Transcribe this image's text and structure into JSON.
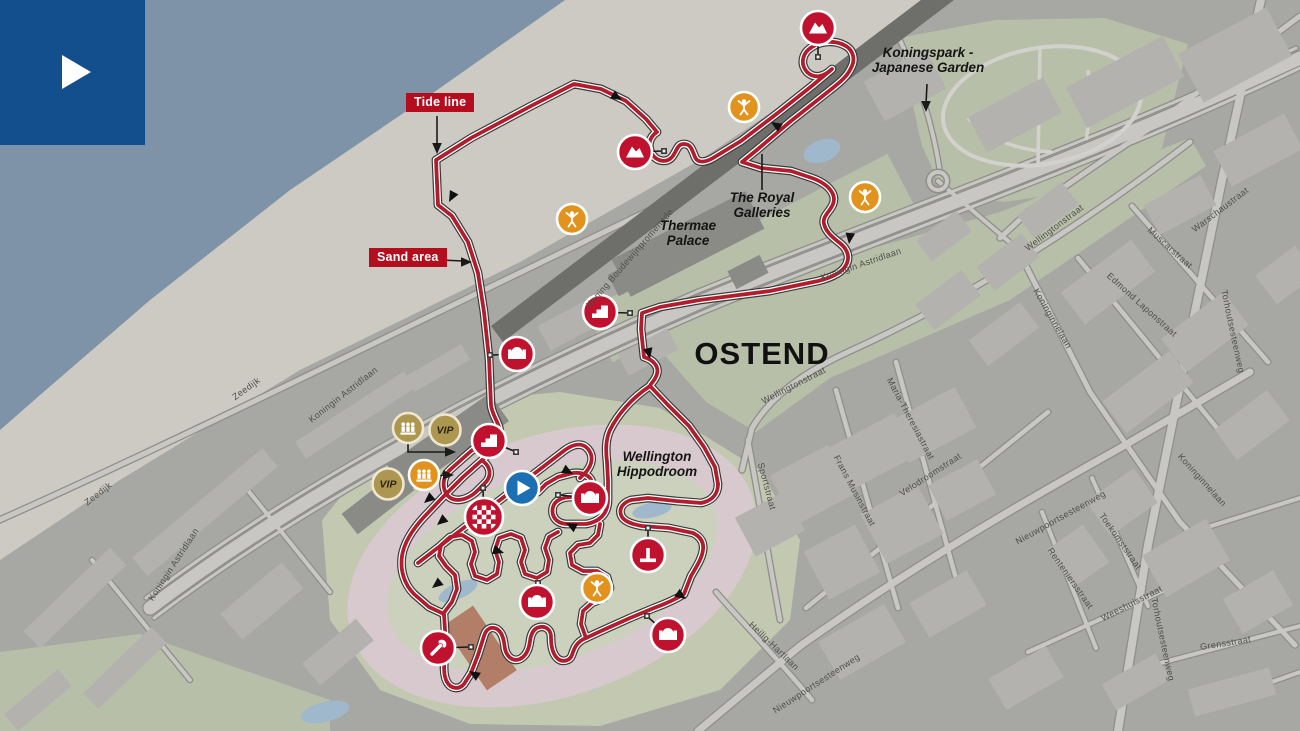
{
  "title": "Ostend cyclocross course map",
  "tags": {
    "tide_line": "Tide line",
    "sand_area": "Sand area"
  },
  "city_label": {
    "text": "OSTEND",
    "x": 762,
    "y": 364,
    "size": 31
  },
  "place_labels": [
    {
      "text": "Thermae\nPalace",
      "x": 688,
      "y": 230
    },
    {
      "text": "The Royal\nGalleries",
      "x": 762,
      "y": 202
    },
    {
      "text": "Koningspark -\nJapanese Garden",
      "x": 928,
      "y": 57
    },
    {
      "text": "Wellington\nHippodroom",
      "x": 657,
      "y": 461
    }
  ],
  "street_labels": [
    {
      "t": "Zeedijk",
      "x": 248,
      "y": 391,
      "r": -36
    },
    {
      "t": "Zeedijk",
      "x": 100,
      "y": 496,
      "r": -38
    },
    {
      "t": "Koningin Astridlaan",
      "x": 345,
      "y": 397,
      "r": -38
    },
    {
      "t": "Koningin Astridlaan",
      "x": 176,
      "y": 566,
      "r": -57
    },
    {
      "t": "Koningin Astridlaan",
      "x": 862,
      "y": 267,
      "r": -19
    },
    {
      "t": "Koning Boudewijnpromenade",
      "x": 632,
      "y": 260,
      "r": -49
    },
    {
      "t": "Warschaustraat",
      "x": 1222,
      "y": 212,
      "r": -37
    },
    {
      "t": "Wellingtonstraat",
      "x": 1056,
      "y": 230,
      "r": -37
    },
    {
      "t": "Wellingtonstraat",
      "x": 795,
      "y": 388,
      "r": -27
    },
    {
      "t": "Muscarstraat",
      "x": 1168,
      "y": 250,
      "r": 42
    },
    {
      "t": "Edmond Laponstraat",
      "x": 1140,
      "y": 307,
      "r": 42
    },
    {
      "t": "Koninginnelaan",
      "x": 1050,
      "y": 320,
      "r": 60
    },
    {
      "t": "Koninginnelaan",
      "x": 1200,
      "y": 482,
      "r": 48
    },
    {
      "t": "Torhoutsesteenweg",
      "x": 1230,
      "y": 332,
      "r": 78
    },
    {
      "t": "Torhoutsesteenweg",
      "x": 1160,
      "y": 640,
      "r": 78
    },
    {
      "t": "Maria-Theresiastraat",
      "x": 908,
      "y": 420,
      "r": 62
    },
    {
      "t": "Frans Musinstraat",
      "x": 852,
      "y": 492,
      "r": 62
    },
    {
      "t": "Velodroomstraat",
      "x": 932,
      "y": 477,
      "r": -33
    },
    {
      "t": "Sportstraat",
      "x": 764,
      "y": 487,
      "r": 75
    },
    {
      "t": "Nieuwpoortsesteenweg",
      "x": 1062,
      "y": 520,
      "r": -29
    },
    {
      "t": "Nieuwpoortsesteenweg",
      "x": 818,
      "y": 686,
      "r": -33
    },
    {
      "t": "Toekomststraat",
      "x": 1118,
      "y": 543,
      "r": 55
    },
    {
      "t": "Renteniersstraat",
      "x": 1068,
      "y": 580,
      "r": 55
    },
    {
      "t": "Weeshuisstraat",
      "x": 1133,
      "y": 606,
      "r": -27
    },
    {
      "t": "Grensstraat",
      "x": 1226,
      "y": 646,
      "r": -9
    },
    {
      "t": "Heilig-Hartlaan",
      "x": 772,
      "y": 648,
      "r": 44
    }
  ],
  "map": {
    "colors": {
      "sea": "#7E93A7",
      "beach": "#CCCAC2",
      "urban": "#A7A7A3",
      "green": "#B8BFA8",
      "hippoGreen": "#C2C9B0",
      "track": "#D8C9CE",
      "infield": "#CCD1BD",
      "building": "#B3B2AE",
      "buildingDark": "#8A8A86",
      "band": "#6E6E6A",
      "roadFill": "#C8C7C3",
      "roadCase": "#8F8F8B",
      "parkPath": "#D2D1CD",
      "pond": "#9FB8CB",
      "pit": "#B27E68",
      "courseRed": "#B01E2E",
      "courseCase": "#FFFFFF",
      "courseEdge": "#3A3A3A",
      "tagRed": "#B30D1E",
      "iconRed": "#C0122F",
      "orange": "#E2931D",
      "gold": "#AD9750",
      "goldRing": "#EFE7CF",
      "blue": "#1B6FB2",
      "logoBlue": "#134F8D",
      "ink": "#141414",
      "streetInk": "#4E4E4A"
    },
    "zones": {
      "sea": "0,0 565,0 430,95 290,190 150,300 40,395 0,430",
      "beach": "565,0 430,95 290,190 150,300 40,395 0,430 0,560 120,480 300,370 520,262 700,160 940,0",
      "greens": [
        "640,314 1000,212 1190,138 1206,166 1010,300 830,378 756,432 706,402 662,352",
        "898,38 995,20 1105,18 1188,44 1162,148 1096,188 1005,202 944,194 922,146",
        "0,652 140,634 330,700 330,731 0,731"
      ],
      "greenRects": [
        [
          750,
          258,
          340,
          58,
          -27.5
        ]
      ]
    },
    "hippodrome": {
      "blob": "322,520 380,448 470,400 560,392 660,408 760,470 800,540 790,620 720,690 600,726 470,724 380,690 330,620",
      "track": [
        552,
        566,
        212,
        130,
        -19.5
      ],
      "infield": [
        552,
        566,
        172,
        94,
        -19.5
      ],
      "parking": [
        543,
        389,
        46,
        13,
        -14
      ]
    },
    "streets": [
      {
        "d": "M150,608 C320,480 520,380 700,302 C900,220 1080,160 1300,58",
        "w": 13
      },
      {
        "d": "M146,598 C316,470 516,370 696,292 C896,210 1076,150 1296,48",
        "w": 3
      },
      {
        "d": "M154,618 C324,490 524,390 704,312 C904,230 1084,170 1300,68",
        "w": 3
      },
      {
        "d": "M-5,522 C180,440 420,320 650,210",
        "w": 5
      },
      {
        "d": "M1300,16 L1150,128 1028,212 1000,238",
        "w": 5
      },
      {
        "d": "M1190,142 C1050,250 940,310 848,352 C800,374 770,398 752,428 L742,470",
        "w": 5
      },
      {
        "d": "M748,440 L780,620",
        "w": 4.5
      },
      {
        "d": "M836,390 L898,608",
        "w": 4.5
      },
      {
        "d": "M896,362 L962,600",
        "w": 4.5
      },
      {
        "d": "M806,608 L1048,412",
        "w": 4.5
      },
      {
        "d": "M1078,258 L1235,450",
        "w": 4.5
      },
      {
        "d": "M1132,206 L1268,362",
        "w": 4.5
      },
      {
        "d": "M1016,246 L1090,392 1180,522 1295,645",
        "w": 5
      },
      {
        "d": "M1262,-5 L1222,180 1185,360 1148,545 1118,731",
        "w": 8
      },
      {
        "d": "M698,731 L800,646 C900,575 1000,515 1120,448 L1250,372",
        "w": 7
      },
      {
        "d": "M1092,478 L1148,606",
        "w": 4
      },
      {
        "d": "M1042,512 L1096,648",
        "w": 4
      },
      {
        "d": "M1028,652 L1178,584",
        "w": 4
      },
      {
        "d": "M1142,668 L1300,626",
        "w": 4
      },
      {
        "d": "M716,592 C740,620 770,650 812,700",
        "w": 4.5
      },
      {
        "d": "M940,172 Q930,105 899,38",
        "w": 4
      },
      {
        "d": "M938,181 L1014,246",
        "w": 4
      },
      {
        "d": "M238,478 L330,592",
        "w": 4
      },
      {
        "d": "M92,560 L190,680",
        "w": 4
      },
      {
        "d": "M1192,532 L1300,498",
        "w": 4
      },
      {
        "d": "M1238,694 L1300,672",
        "w": 4
      }
    ],
    "roundabout": [
      938,
      181,
      9
    ],
    "park_paths": [
      "M968,118 Q1000,150 1052,152",
      "M1088,70 Q1092,110 1086,140",
      "M1040,48 L1038,164"
    ],
    "park_ring": [
      1042,
      106,
      100,
      58,
      -10
    ],
    "band": {
      "d": "M497,334 L948,-8",
      "w": 20
    },
    "buildings": [
      [
        355,
        415,
        130,
        20,
        -33,
        0
      ],
      [
        205,
        512,
        170,
        24,
        -40,
        0
      ],
      [
        75,
        598,
        120,
        24,
        -44,
        0
      ],
      [
        125,
        668,
        95,
        22,
        -44,
        0
      ],
      [
        262,
        601,
        80,
        34,
        -40,
        0
      ],
      [
        338,
        652,
        70,
        28,
        -40,
        0
      ],
      [
        438,
        368,
        64,
        18,
        -30,
        0
      ],
      [
        38,
        700,
        70,
        22,
        -40,
        0
      ],
      [
        575,
        322,
        70,
        28,
        -28,
        0
      ],
      [
        648,
        352,
        56,
        24,
        -28,
        0
      ],
      [
        688,
        244,
        150,
        42,
        -27,
        1
      ],
      [
        640,
        272,
        60,
        24,
        -27,
        1
      ],
      [
        748,
        272,
        36,
        20,
        -27,
        1
      ],
      [
        448,
        443,
        125,
        34,
        -35,
        1
      ],
      [
        378,
        502,
        72,
        26,
        -38,
        1
      ],
      [
        1235,
        55,
        100,
        55,
        -28,
        0
      ],
      [
        1125,
        82,
        110,
        46,
        -28,
        0
      ],
      [
        1015,
        115,
        85,
        40,
        -28,
        0
      ],
      [
        905,
        85,
        70,
        45,
        -28,
        0
      ],
      [
        1258,
        150,
        80,
        40,
        -28,
        0
      ],
      [
        1180,
        205,
        64,
        34,
        -28,
        0
      ],
      [
        1108,
        282,
        88,
        40,
        -37,
        0
      ],
      [
        1205,
        332,
        78,
        42,
        -37,
        0
      ],
      [
        1148,
        392,
        84,
        40,
        -37,
        0
      ],
      [
        1252,
        425,
        66,
        38,
        -37,
        0
      ],
      [
        1286,
        275,
        50,
        36,
        -37,
        0
      ],
      [
        1008,
        262,
        56,
        30,
        -37,
        0
      ],
      [
        948,
        300,
        58,
        32,
        -37,
        0
      ],
      [
        1004,
        334,
        64,
        32,
        -37,
        0
      ],
      [
        812,
        485,
        56,
        66,
        62,
        0
      ],
      [
        872,
        452,
        48,
        76,
        62,
        0
      ],
      [
        932,
        425,
        46,
        76,
        62,
        0
      ],
      [
        902,
        524,
        56,
        64,
        62,
        0
      ],
      [
        842,
        562,
        54,
        58,
        62,
        0
      ],
      [
        962,
        490,
        40,
        56,
        62,
        0
      ],
      [
        770,
        524,
        44,
        56,
        62,
        0
      ],
      [
        1122,
        502,
        42,
        58,
        55,
        0
      ],
      [
        1078,
        556,
        46,
        44,
        55,
        0
      ],
      [
        1186,
        558,
        74,
        48,
        -30,
        0
      ],
      [
        1258,
        602,
        58,
        40,
        -30,
        0
      ],
      [
        1136,
        682,
        62,
        30,
        -30,
        0
      ],
      [
        1232,
        692,
        84,
        28,
        -15,
        0
      ],
      [
        862,
        642,
        76,
        44,
        -30,
        0
      ],
      [
        948,
        604,
        66,
        40,
        -30,
        0
      ],
      [
        1026,
        678,
        66,
        36,
        -30,
        0
      ],
      [
        944,
        236,
        50,
        26,
        -37,
        0
      ],
      [
        1048,
        210,
        56,
        28,
        -37,
        0
      ]
    ],
    "pit": [
      480,
      648,
      36,
      78,
      -34
    ],
    "ponds": [
      [
        652,
        510,
        40,
        15,
        -12
      ],
      [
        458,
        591,
        42,
        16,
        -24
      ],
      [
        325,
        712,
        50,
        20,
        -14
      ],
      [
        822,
        151,
        38,
        22,
        -20
      ]
    ],
    "course": {
      "paths": [
        "M489,358 L484,312 478,273 468,242 452,216 438,205 436,160 471,138 531,106 574,84 601,89 626,101 646,119 657,132 C649,137 647,147 652,154 C657,162 667,163 672,157 C677,151 677,144 684,144 C691,144 692,150 695,157 C698,164 706,162 713,158 L741,141 779,112 813,85 832,69 C824,77 814,79 807,72 C800,64 802,53 812,47 C821,41 834,40 844,45 C853,49 856,59 851,68 C847,77 839,83 829,91 L791,121 758,149 742,162 L761,168 791,171 809,177 C828,183 837,194 833,204 C830,212 822,216 824,224 C826,232 832,237 841,244 C848,250 850,258 846,265 C842,273 830,278 818,281 L770,291 700,300 660,307 642,313 L641,329 644,357 C654,360 659,367 657,374 C655,381 650,384 650,386 L668,405 689,426 704,447 715,467 718,484",
        "M718,484 C718,495 711,501 701,503 L676,501 648,498 631,500 C622,503 619,509 621,515 C623,521 631,524 642,526 L669,528 693,533 C701,537 704,543 703,550 C702,558 697,566 691,576 L684,594 C676,599 665,604 654,608 L630,618 601,631 586,638 C576,642 574,649 572,655 C570,661 562,663 557,658 C552,653 551,645 551,637 C551,630 546,626 540,627 C534,628 531,633 530,641 C529,649 526,656 520,659 C513,662 507,657 505,649 C504,641 503,633 497,629 C491,626 486,629 484,636 L478,655 471,673 464,684 C459,690 451,689 447,682 C443,675 444,664 445,652 L445,630 444,614 L429,607 414,594 C404,584 400,570 402,556 C404,543 412,530 424,517 L443,497 463,477 481,461 495,448 C500,441 501,434 499,427 C497,420 492,414 491,405 L489,358",
        "M418,563 L565,450 C575,443 583,443 588,449 C594,456 592,465 586,472 L580,478",
        "M650,386 C632,398 618,414 610,430 C605,441 606,452 607,462 L608,480 608,500 C608,514 599,522 586,524 L566,524 C555,523 551,515 553,507 C555,500 563,497 572,497 L583,496 C591,495 594,489 592,482 C590,475 582,472 573,473 L558,477 546,484 538,492",
        "M498,430 L470,452 452,468 C441,477 442,489 448,496 C455,503 467,500 476,492 L486,482 C492,475 490,467 484,462",
        "M443,614 L452,602 457,589 455,575 446,566 439,556 441,545 450,537 462,535 472,541 475,552 471,564 475,576 487,580 497,574 499,562 495,550 499,538 511,534 521,538 525,550 521,562 525,574 537,578 547,572 549,560 545,548 549,537 558,532",
        "M586,638 L581,624 583,611 592,603 604,598 610,588 607,577 597,571 583,571 572,565 570,553 578,545 590,543 598,535 600,524"
      ],
      "arrows": [
        [
          622,
          100,
          30
        ],
        [
          449,
          202,
          118
        ],
        [
          771,
          122,
          212
        ],
        [
          849,
          244,
          97
        ],
        [
          650,
          359,
          78
        ],
        [
          573,
          474,
          28
        ],
        [
          686,
          599,
          35
        ],
        [
          424,
          503,
          140
        ],
        [
          437,
          525,
          140
        ],
        [
          504,
          553,
          18
        ],
        [
          432,
          588,
          142
        ],
        [
          469,
          671,
          212
        ],
        [
          566,
          523,
          207
        ]
      ],
      "markers": [
        [
          664,
          151
        ],
        [
          818,
          57
        ],
        [
          630,
          313
        ],
        [
          490,
          355
        ],
        [
          516,
          452
        ],
        [
          483,
          488
        ],
        [
          558,
          495
        ],
        [
          648,
          528
        ],
        [
          538,
          583
        ],
        [
          647,
          616
        ],
        [
          471,
          647
        ]
      ]
    },
    "connectors": [
      {
        "d": "M635,152 L662,151"
      },
      {
        "d": "M818,30 L818,55"
      },
      {
        "d": "M600,312 L628,313"
      },
      {
        "d": "M517,354 L492,355"
      },
      {
        "d": "M489,441 L514,451"
      },
      {
        "d": "M484,515 L483,490"
      },
      {
        "d": "M588,498 L560,495"
      },
      {
        "d": "M648,553 L648,530"
      },
      {
        "d": "M537,600 L538,585"
      },
      {
        "d": "M666,633 L649,618"
      },
      {
        "d": "M440,648 L469,647"
      },
      {
        "d": "M408,430 L408,452 L448,452",
        "head": [
          456,
          452,
          0
        ]
      },
      {
        "d": "M424,477 L446,475",
        "head": [
          454,
          475,
          0
        ]
      },
      {
        "d": "M437,116 L437,146",
        "head": [
          437,
          154,
          90
        ]
      },
      {
        "d": "M440,260 L464,261",
        "head": [
          472,
          262,
          0
        ]
      },
      {
        "d": "M762,190 L762,154"
      },
      {
        "d": "M927,84 L926,104",
        "head": [
          926,
          112,
          90
        ]
      }
    ],
    "icons": [
      {
        "type": "mountain",
        "name": "sand-dune-icon",
        "x": 635,
        "y": 152
      },
      {
        "type": "mountain",
        "name": "sand-dune-icon",
        "x": 818,
        "y": 28
      },
      {
        "type": "fans",
        "name": "fan-zone-icon",
        "x": 572,
        "y": 219
      },
      {
        "type": "fans",
        "name": "fan-zone-icon",
        "x": 744,
        "y": 107
      },
      {
        "type": "fans",
        "name": "fan-zone-icon",
        "x": 865,
        "y": 197
      },
      {
        "type": "fans",
        "name": "fan-zone-icon",
        "x": 597,
        "y": 588
      },
      {
        "type": "stairs",
        "name": "stairs-icon",
        "x": 600,
        "y": 312
      },
      {
        "type": "stairs",
        "name": "stairs-icon",
        "x": 489,
        "y": 441
      },
      {
        "type": "bridge",
        "name": "bridge-icon",
        "x": 517,
        "y": 354
      },
      {
        "type": "bridge",
        "name": "bridge-icon",
        "x": 590,
        "y": 498
      },
      {
        "type": "bridge",
        "name": "bridge-icon",
        "x": 537,
        "y": 602
      },
      {
        "type": "bridge",
        "name": "bridge-icon",
        "x": 668,
        "y": 635
      },
      {
        "type": "barrier",
        "name": "barrier-icon",
        "x": 648,
        "y": 555
      },
      {
        "type": "wrench",
        "name": "pit-material-icon",
        "x": 438,
        "y": 648
      },
      {
        "type": "finish",
        "name": "finish-flag-icon",
        "x": 484,
        "y": 517
      },
      {
        "type": "start",
        "name": "start-icon",
        "x": 522,
        "y": 488
      },
      {
        "type": "stand",
        "name": "grandstand-icon",
        "x": 408,
        "y": 428,
        "gold": true
      },
      {
        "type": "stand",
        "name": "grandstand-icon",
        "x": 424,
        "y": 475,
        "gold": false
      },
      {
        "type": "vip",
        "name": "vip-icon",
        "x": 445,
        "y": 430,
        "label": "VIP"
      },
      {
        "type": "vip",
        "name": "vip-icon",
        "x": 388,
        "y": 484,
        "label": "VIP"
      }
    ]
  }
}
